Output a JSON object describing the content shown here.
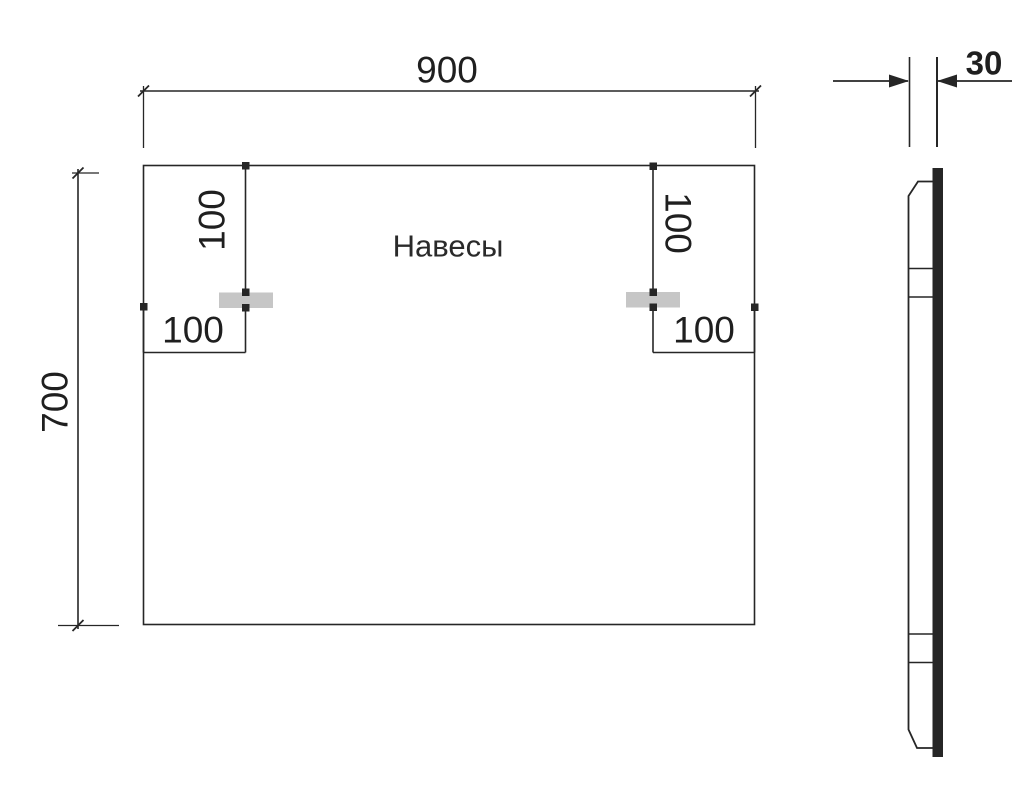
{
  "drawing": {
    "hangers_label": "Навесы",
    "dims": {
      "width": "900",
      "height": "700",
      "thickness": "30",
      "hanger_left_top_offset": "100",
      "hanger_left_side_offset": "100",
      "hanger_right_top_offset": "100",
      "hanger_right_side_offset": "100"
    },
    "colors": {
      "line": "#262626",
      "hanger_fill": "#c6c6c6",
      "background": "#ffffff"
    }
  }
}
